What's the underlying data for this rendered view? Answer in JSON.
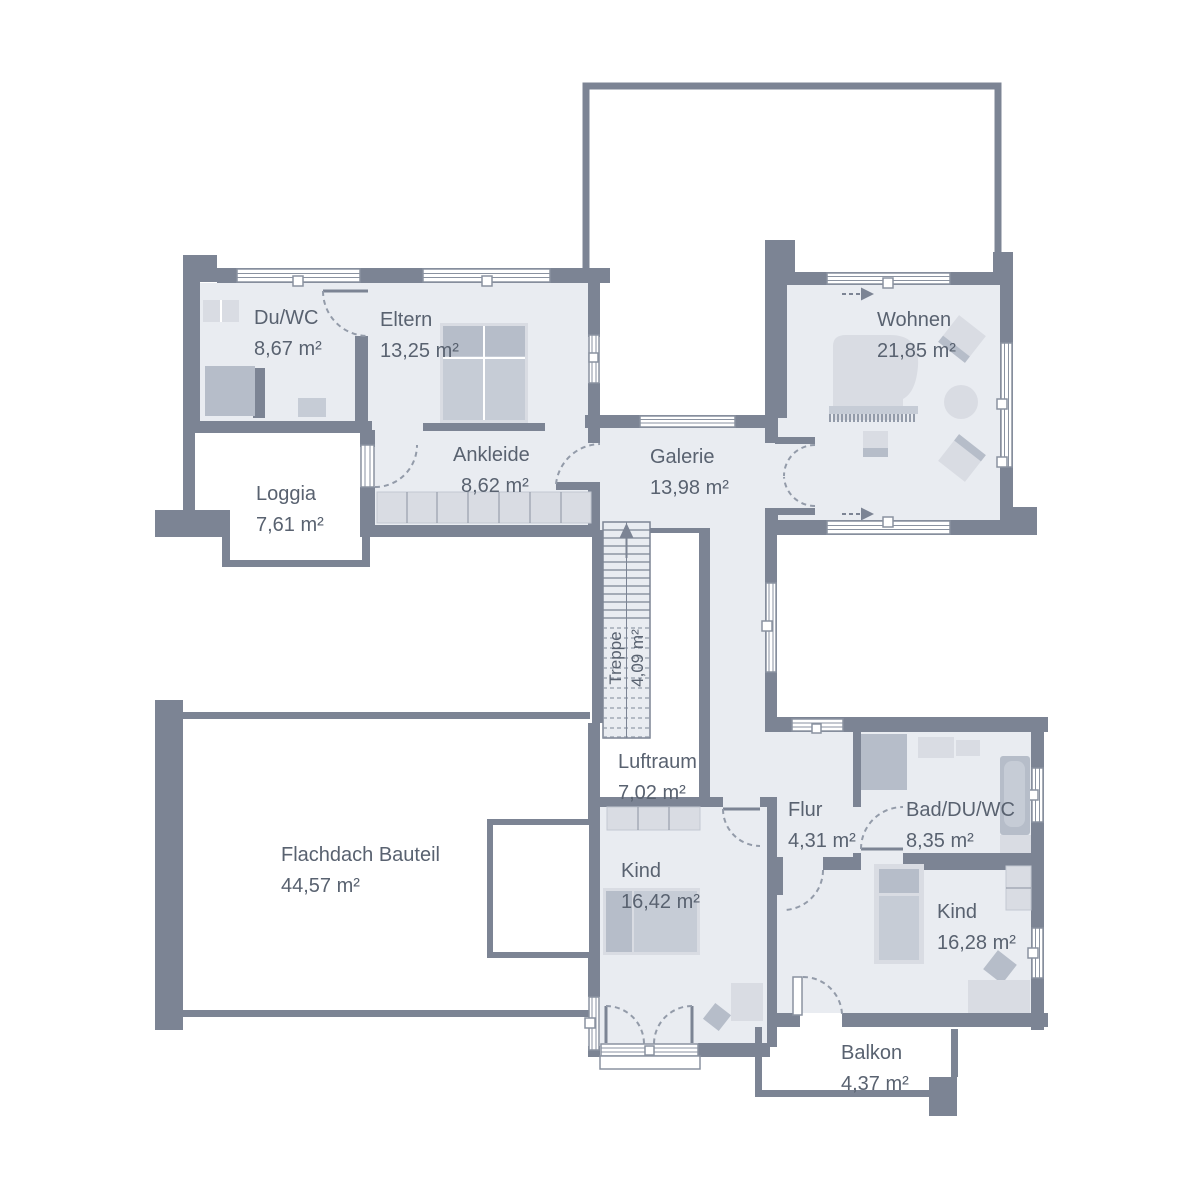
{
  "title": "Obergeschoss Grundriss",
  "rooms": {
    "duwc": {
      "name": "Du/WC",
      "area": "8,67 m²"
    },
    "eltern": {
      "name": "Eltern",
      "area": "13,25 m²"
    },
    "wohnen": {
      "name": "Wohnen",
      "area": "21,85 m²"
    },
    "ankleide": {
      "name": "Ankleide",
      "area": "8,62 m²"
    },
    "galerie": {
      "name": "Galerie",
      "area": "13,98 m²"
    },
    "loggia": {
      "name": "Loggia",
      "area": "7,61 m²"
    },
    "treppe": {
      "name": "Treppe",
      "area": "4,09 m²"
    },
    "luftraum": {
      "name": "Luftraum",
      "area": "7,02 m²"
    },
    "flur": {
      "name": "Flur",
      "area": "4,31 m²"
    },
    "bad": {
      "name": "Bad/DU/WC",
      "area": "8,35 m²"
    },
    "flachdach": {
      "name": "Flachdach Bauteil",
      "area": "44,57 m²"
    },
    "kind1": {
      "name": "Kind",
      "area": "16,42 m²"
    },
    "kind2": {
      "name": "Kind",
      "area": "16,28 m²"
    },
    "balkon": {
      "name": "Balkon",
      "area": "4,37 m²"
    }
  },
  "icons": {
    "stairs_up_arrow": "triangle-up",
    "sliding_direction_arrow": "triangle-right"
  },
  "colors": {
    "wall": "#7c8494",
    "room": "#e9ecf1",
    "text": "#596270",
    "frame": "#8a92a0",
    "arc": "#939ba9",
    "furnA": "#d9dce3",
    "furnB": "#c6ccd6",
    "furnC": "#b6bdc9",
    "furnEdge": "#c2c8d2"
  }
}
